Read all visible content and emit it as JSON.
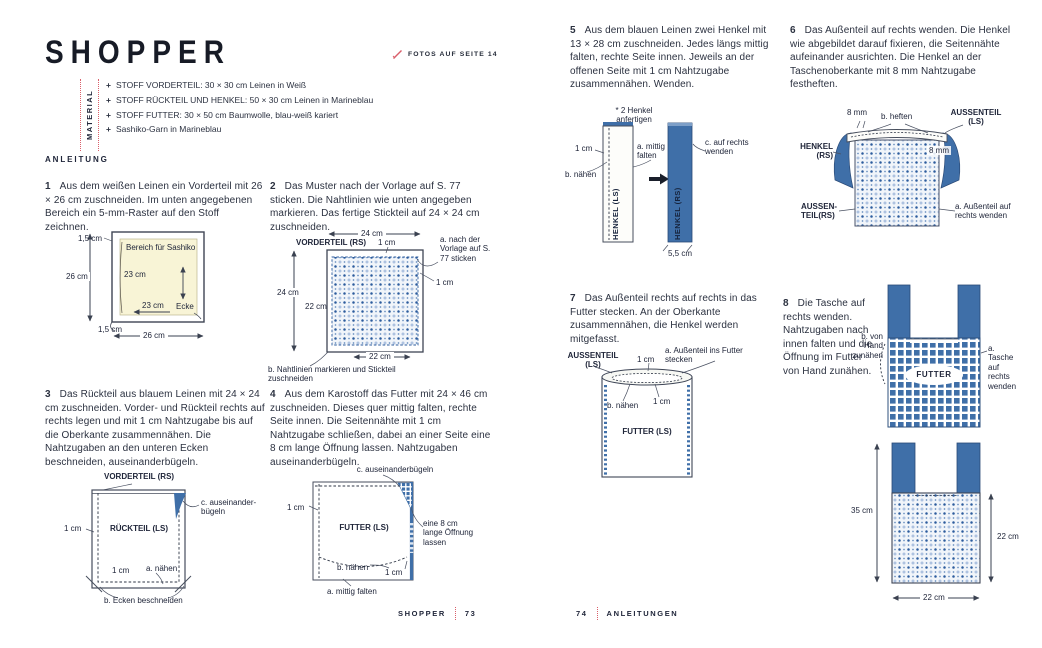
{
  "colors": {
    "accent_red": "#d95f6a",
    "fabric_blue": "#3f6fa8",
    "ink": "#262c3a",
    "sashiko_area_yellow": "#f8f4d6"
  },
  "left_page": {
    "title": "SHOPPER",
    "photos_link": "FOTOS AUF SEITE 14",
    "material": {
      "label": "MATERIAL",
      "bullet": "+",
      "items": [
        "STOFF VORDERTEIL: 30 × 30 cm Leinen in Weiß",
        "STOFF RÜCKTEIL UND HENKEL: 50 × 30 cm Leinen in Marineblau",
        "STOFF FUTTER: 30 × 50 cm Baumwolle, blau-weiß kariert",
        "Sashiko-Garn in Marineblau"
      ]
    },
    "section_label": "ANLEITUNG",
    "footer_title": "SHOPPER",
    "footer_page": "73"
  },
  "right_page": {
    "footer_page": "74",
    "footer_title": "ANLEITUNGEN"
  },
  "steps": {
    "s1": {
      "num": "1",
      "text": "Aus dem weißen Leinen ein Vorderteil mit 26 × 26 cm zuschneiden. Im unten angegebenen Bereich ein 5-mm-Raster auf den Stoff zeichnen."
    },
    "s2": {
      "num": "2",
      "text": "Das Muster nach der Vorlage auf S. 77 sticken. Die Nahtlinien wie unten angegeben markieren. Das fertige Stickteil auf 24 × 24 cm zuschneiden."
    },
    "s3": {
      "num": "3",
      "text": "Das Rückteil aus blauem Leinen mit 24 × 24 cm zuschneiden. Vorder- und Rückteil rechts auf rechts legen und mit 1 cm Nahtzugabe bis auf die Oberkante zusammennähen. Die Nahtzugaben an den unteren Ecken beschneiden, auseinanderbügeln."
    },
    "s4": {
      "num": "4",
      "text": "Aus dem Karostoff das Futter mit 24 × 46 cm zuschneiden. Dieses quer mittig falten, rechte Seite innen. Die Seitennähte mit 1 cm Nahtzugabe schließen, dabei an einer Seite eine 8 cm lange Öffnung lassen. Nahtzugaben auseinanderbügeln."
    },
    "s5": {
      "num": "5",
      "text": "Aus dem blauen Leinen zwei Henkel mit 13 × 28 cm zuschneiden. Jedes längs mittig falten, rechte Seite innen. Jeweils an der offenen Seite mit 1 cm Nahtzugabe zusammennähen. Wenden."
    },
    "s6": {
      "num": "6",
      "text": "Das Außenteil auf rechts wenden. Die Henkel wie abgebildet darauf fixieren, die Seitennähte aufeinander ausrichten. Die Henkel an der Taschenoberkante mit 8 mm Nahtzugabe festheften."
    },
    "s7": {
      "num": "7",
      "text": "Das Außenteil rechts auf rechts in das Futter stecken. An der Oberkante zusammennähen, die Henkel werden mitgefasst."
    },
    "s8": {
      "num": "8",
      "text": "Die Tasche auf rechts wenden. Nahtzugaben nach innen falten und die Öffnung im Futter von Hand zunähen."
    }
  },
  "d1": {
    "off_top": "1,5 cm",
    "h_outer": "26 cm",
    "area": "Bereich für Sashiko",
    "h_inner": "23 cm",
    "w_inner": "23 cm",
    "corner": "Ecke",
    "off_bottom": "1,5 cm",
    "w_outer": "26 cm"
  },
  "d2": {
    "w_top": "24 cm",
    "title": "VORDERTEIL (RS)",
    "seam_top": "1 cm",
    "note_a": "a. nach der Vorlage auf S. 77 sticken",
    "seam_right": "1 cm",
    "h_left": "24 cm",
    "h_inner": "22 cm",
    "w_inner": "22 cm",
    "note_b": "b. Nahtlinien markieren und Stickteil zuschneiden"
  },
  "d3": {
    "top": "VORDERTEIL (RS)",
    "center": "RÜCKTEIL (LS)",
    "seam_left": "1 cm",
    "note_c": "c. auseinander- bügeln",
    "seam_bottom": "1 cm",
    "note_a": "a. nähen",
    "note_b": "b. Ecken beschneiden"
  },
  "d4": {
    "note_c": "c. auseinanderbügeln",
    "seam_left": "1 cm",
    "center": "FUTTER (LS)",
    "note_open": "eine 8 cm lange Öffnung lassen",
    "note_b": "b. nähen",
    "seam_bottom": "1 cm",
    "note_a": "a. mittig falten"
  },
  "d5": {
    "note_make": "* 2 Henkel anfertigen",
    "seam": "1 cm",
    "note_b": "b. nähen",
    "label_ls": "HENKEL (LS)",
    "note_a": "a. mittig falten",
    "label_rs": "HENKEL (RS)",
    "note_c": "c. auf rechts wenden",
    "width": "5,5 cm"
  },
  "d6": {
    "mm_left": "8 mm",
    "note_b": "b. heften",
    "label_ls": "AUSSENTEIL (LS)",
    "label_henkel": "HENKEL (RS)",
    "mm_right": "8 mm",
    "label_rs": "AUSSEN- TEIL(RS)",
    "note_a": "a. Außenteil auf rechts wenden"
  },
  "d7": {
    "label_aussen": "AUSSENTEIL (LS)",
    "seam_top": "1 cm",
    "note_a": "a. Außenteil ins Futter stecken",
    "note_b": "b. nähen",
    "seam_inner": "1 cm",
    "label_futter": "FUTTER (LS)"
  },
  "d8": {
    "note_b": "b. von Hand zunähen",
    "label": "FUTTER",
    "note_a": "a. Tasche auf rechts wenden"
  },
  "d9": {
    "h_total": "35 cm",
    "h_body": "22 cm",
    "w_body": "22 cm"
  }
}
